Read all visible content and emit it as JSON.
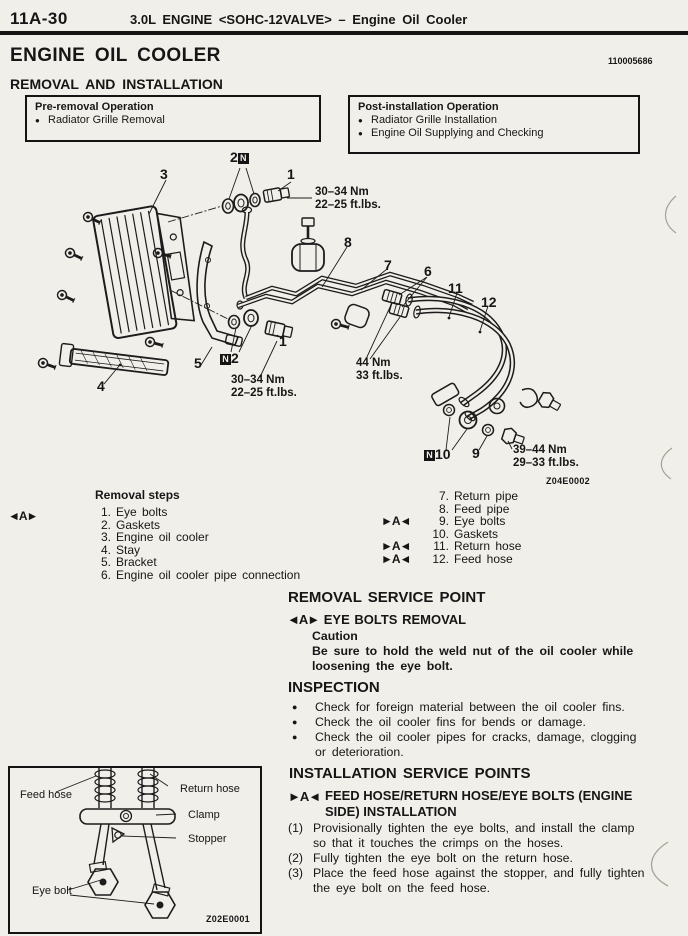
{
  "colors": {
    "paper": "#f1efe9",
    "ink": "#161616"
  },
  "page": {
    "page_number": "11A-30",
    "running_header": "3.0L ENGINE <SOHC-12VALVE> – Engine Oil Cooler",
    "title": "ENGINE OIL COOLER",
    "doc_number": "110005686",
    "section_heading": "REMOVAL AND INSTALLATION"
  },
  "pre_removal": {
    "title": "Pre-removal Operation",
    "bullet": "●",
    "items": [
      "Radiator Grille Removal"
    ]
  },
  "post_installation": {
    "title": "Post-installation Operation",
    "bullet": "●",
    "items": [
      "Radiator Grille Installation",
      "Engine Oil Supplying and Checking"
    ]
  },
  "diagram": {
    "figure_code": "Z04E0002",
    "n_badge": "N",
    "labels": {
      "part3": "3",
      "part2_top": "2",
      "part1_top": "1",
      "part8": "8",
      "part7": "7",
      "part6": "6",
      "part11": "11",
      "part12": "12",
      "part1_mid": "1",
      "part5": "5",
      "part2_mid": "2",
      "part4": "4",
      "part10": "10",
      "part9": "9"
    },
    "torques": {
      "top_nm": "30–34 Nm",
      "top_ft": "22–25 ft.lbs.",
      "mid_nm": "30–34 Nm",
      "mid_ft": "22–25 ft.lbs.",
      "hose_nm": "44 Nm",
      "hose_ft": "33 ft.lbs.",
      "eye_nm": "39–44 Nm",
      "eye_ft": "29–33 ft.lbs."
    }
  },
  "removal_steps": {
    "title": "Removal steps",
    "marker": "◄A►",
    "left": [
      {
        "num": "1.",
        "text": "Eye bolts"
      },
      {
        "num": "2.",
        "text": "Gaskets"
      },
      {
        "num": "3.",
        "text": "Engine oil cooler"
      },
      {
        "num": "4.",
        "text": "Stay"
      },
      {
        "num": "5.",
        "text": "Bracket"
      },
      {
        "num": "6.",
        "text": "Engine oil cooler pipe connection"
      }
    ],
    "right": [
      {
        "marker": "",
        "num": "7.",
        "text": "Return pipe"
      },
      {
        "marker": "",
        "num": "8.",
        "text": "Feed pipe"
      },
      {
        "marker": "►A◄",
        "num": "9.",
        "text": "Eye bolts"
      },
      {
        "marker": "",
        "num": "10.",
        "text": "Gaskets"
      },
      {
        "marker": "►A◄",
        "num": "11.",
        "text": "Return hose"
      },
      {
        "marker": "►A◄",
        "num": "12.",
        "text": "Feed hose"
      }
    ]
  },
  "removal_service_point": {
    "heading": "REMOVAL SERVICE POINT",
    "marker": "◄A►",
    "sub_heading": "EYE BOLTS REMOVAL",
    "caution_label": "Caution",
    "caution_lines": [
      "Be sure to hold the weld nut of the oil cooler while",
      "loosening the eye bolt."
    ]
  },
  "inspection": {
    "heading": "INSPECTION",
    "bullet": "●",
    "items": [
      {
        "lines": [
          "Check for foreign material between the oil cooler fins."
        ]
      },
      {
        "lines": [
          "Check the oil cooler fins for bends or damage."
        ]
      },
      {
        "lines": [
          "Check the oil cooler pipes for cracks, damage, clogging",
          "or deterioration."
        ]
      }
    ]
  },
  "installation_service_points": {
    "heading": "INSTALLATION SERVICE POINTS",
    "marker": "►A◄",
    "sub_heading_lines": [
      "FEED HOSE/RETURN HOSE/EYE BOLTS (ENGINE",
      "SIDE) INSTALLATION"
    ],
    "steps": [
      {
        "num": "(1)",
        "lines": [
          "Provisionally tighten the eye bolts, and install the clamp",
          "so that it touches the crimps on the hoses."
        ]
      },
      {
        "num": "(2)",
        "lines": [
          "Fully tighten the eye bolt on the return hose."
        ]
      },
      {
        "num": "(3)",
        "lines": [
          "Place the feed hose against the stopper, and fully tighten",
          "the eye bolt on the feed hose."
        ]
      }
    ]
  },
  "inset": {
    "figure_code": "Z02E0001",
    "labels": {
      "feed_hose": "Feed hose",
      "return_hose": "Return hose",
      "clamp": "Clamp",
      "stopper": "Stopper",
      "eye_bolt": "Eye bolt"
    }
  }
}
